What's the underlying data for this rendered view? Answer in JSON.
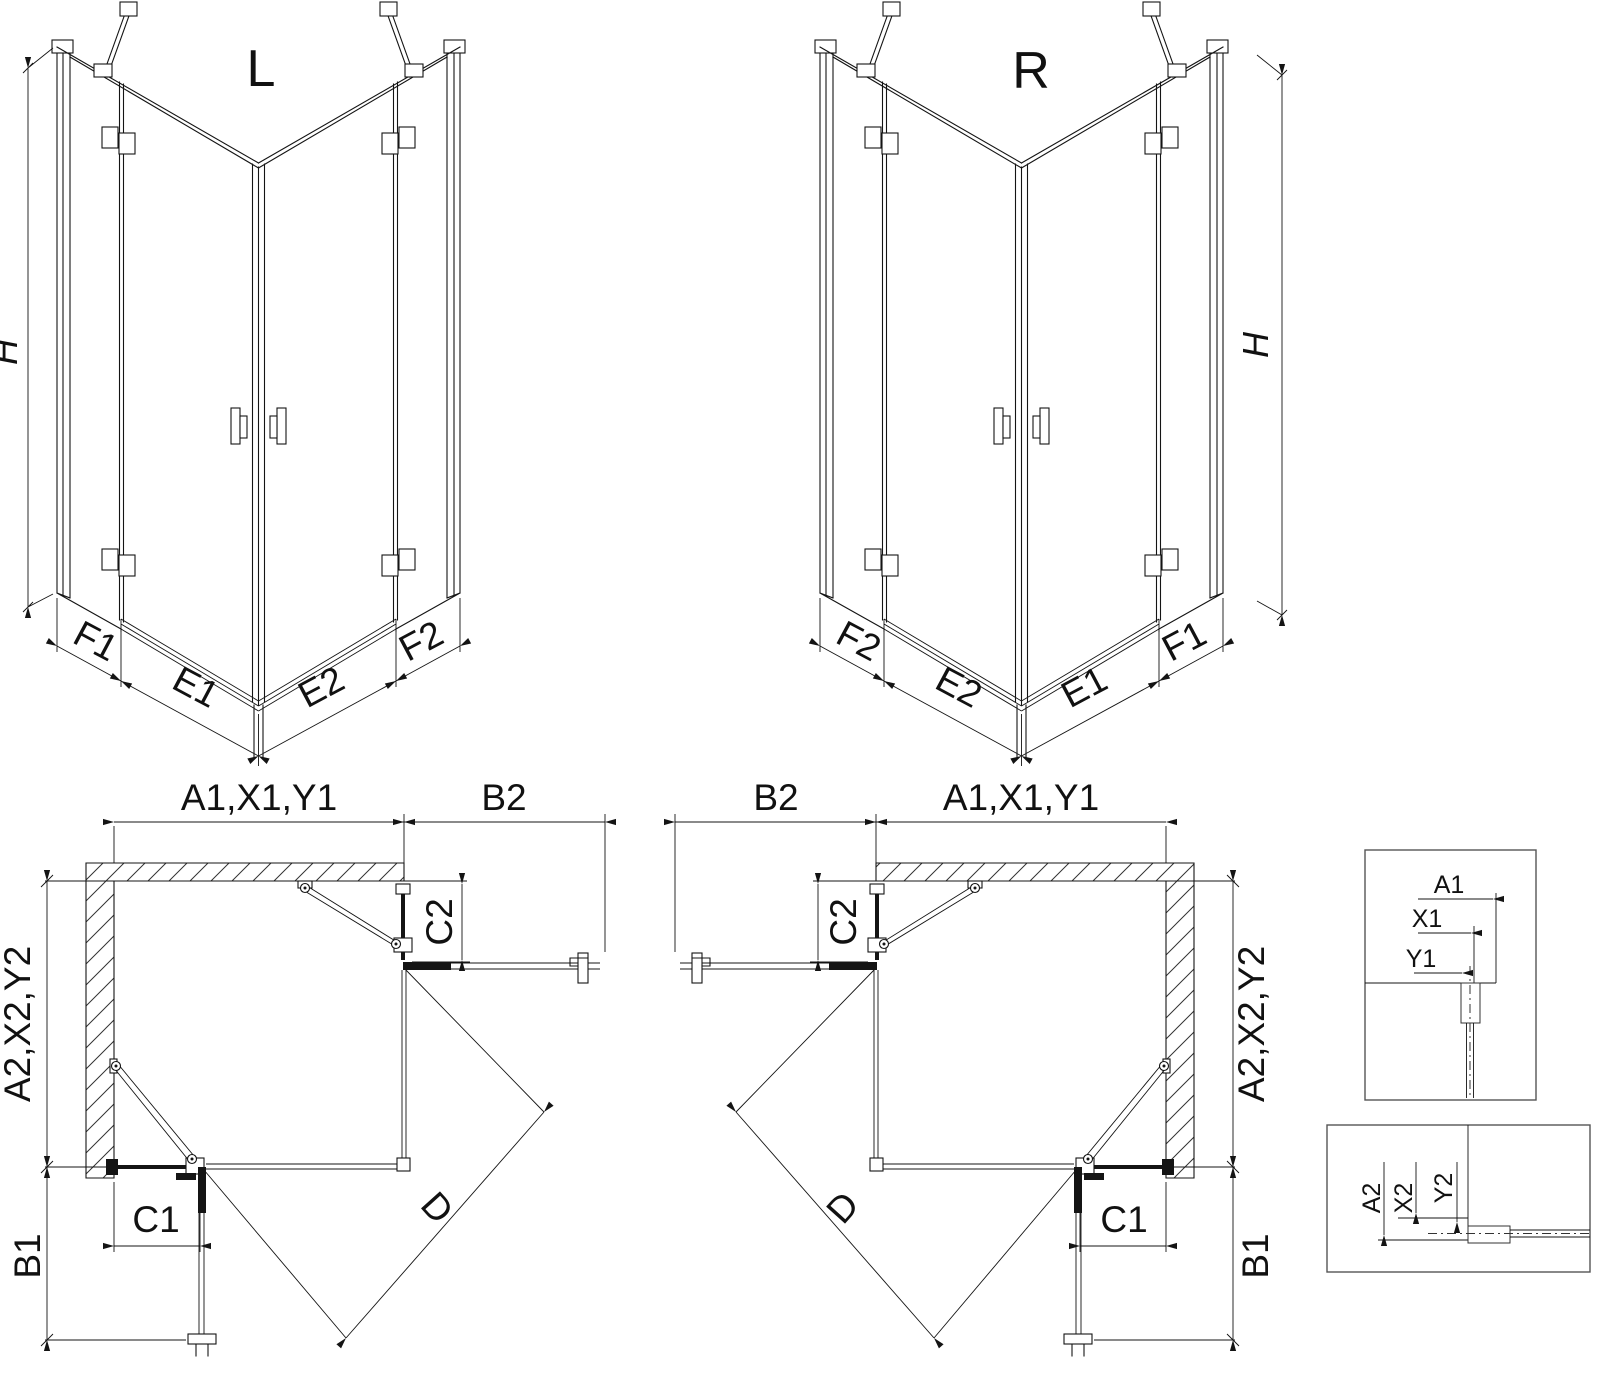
{
  "labels": {
    "view_left": "L",
    "view_right": "R",
    "height": "H",
    "f1": "F1",
    "e1": "E1",
    "e2": "E2",
    "f2": "F2",
    "a1x1y1": "A1,X1,Y1",
    "b2": "B2",
    "c2": "C2",
    "a2x2y2": "A2,X2,Y2",
    "c1": "C1",
    "b1": "B1",
    "d": "D",
    "a1": "A1",
    "x1": "X1",
    "y1": "Y1",
    "a2": "A2",
    "x2": "X2",
    "y2": "Y2"
  },
  "colors": {
    "line": "#141414",
    "detail_border": "#555555",
    "background": "#ffffff"
  }
}
